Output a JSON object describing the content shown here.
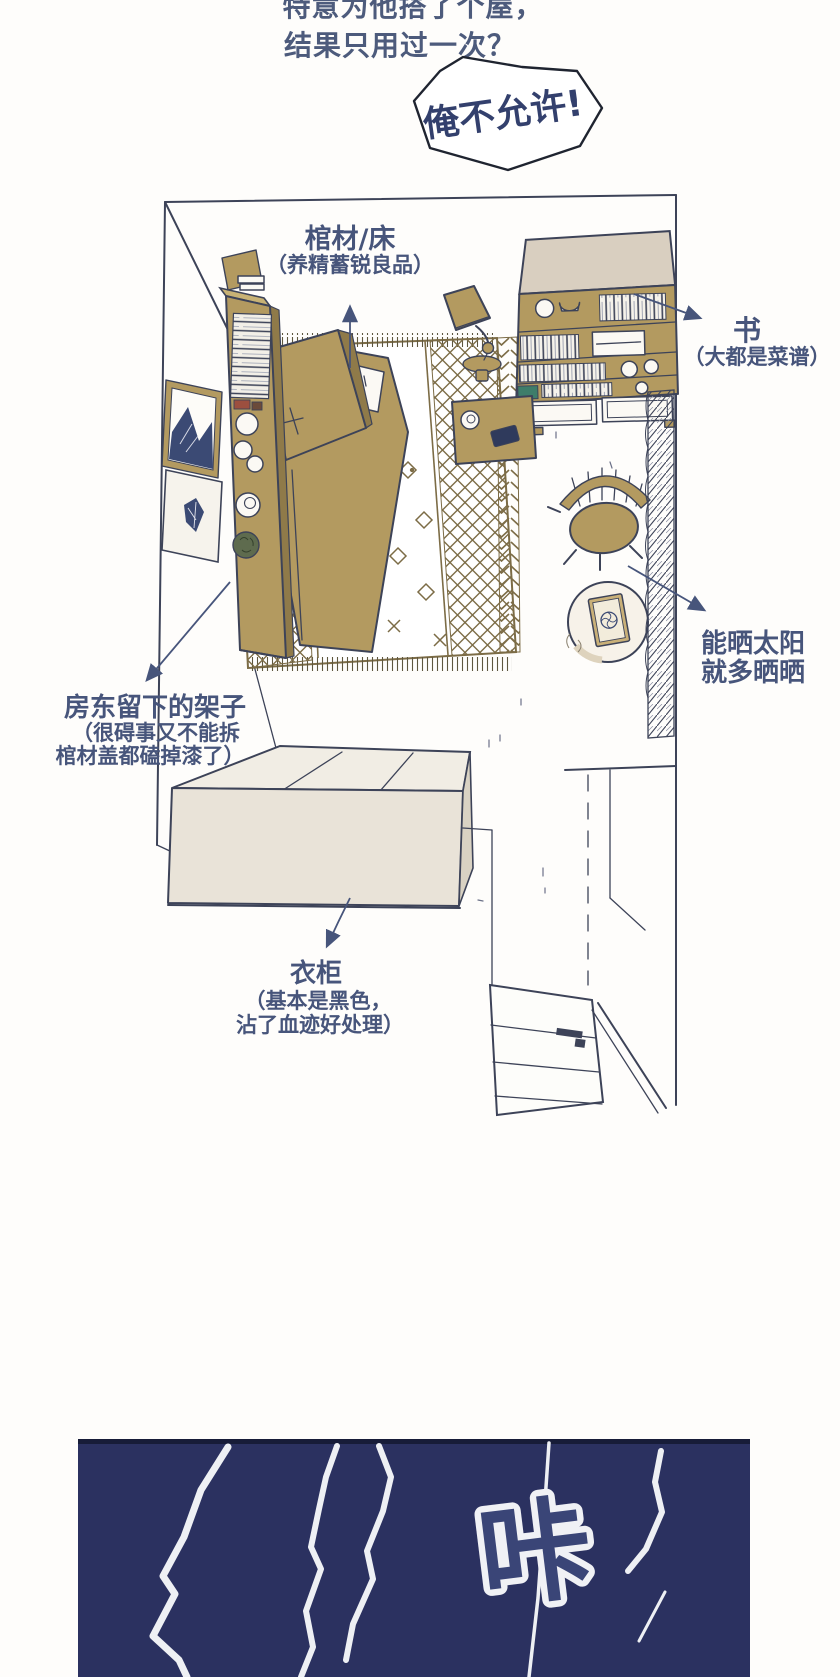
{
  "narration": {
    "line1": "特意为他搭了个屋，",
    "line2": "结果只用过一次？"
  },
  "speech_bubble": {
    "text": "俺不允许!"
  },
  "room_labels": {
    "coffin": {
      "title": "棺材/床",
      "subtitle": "（养精蓄锐良品）"
    },
    "books": {
      "title": "书",
      "subtitle": "（大都是菜谱）"
    },
    "landlord_shelf": {
      "title": "房东留下的架子",
      "subtitle1": "（很碍事又不能拆",
      "subtitle2": "棺材盖都磕掉漆了）"
    },
    "sunbathing": {
      "line1": "能晒太阳",
      "line2": "就多晒晒"
    },
    "wardrobe": {
      "title": "衣柜",
      "subtitle1": "（基本是黑色，",
      "subtitle2": "沾了血迹好处理）"
    }
  },
  "sfx": {
    "crack": "咔"
  },
  "colors": {
    "furniture_tan": "#b39a60",
    "outline_navy": "#3d4358",
    "label_text": "#47557b",
    "narration_text": "#4d5b7c",
    "panel_navy": "#2b3160",
    "rug_pattern": "#7c6c46",
    "wardrobe_beige": "#e9e3d8",
    "sfx_glyph_fill": "#3a4577",
    "sfx_glyph_outline": "#f0f1f5",
    "crack_line": "#eef0f4"
  }
}
